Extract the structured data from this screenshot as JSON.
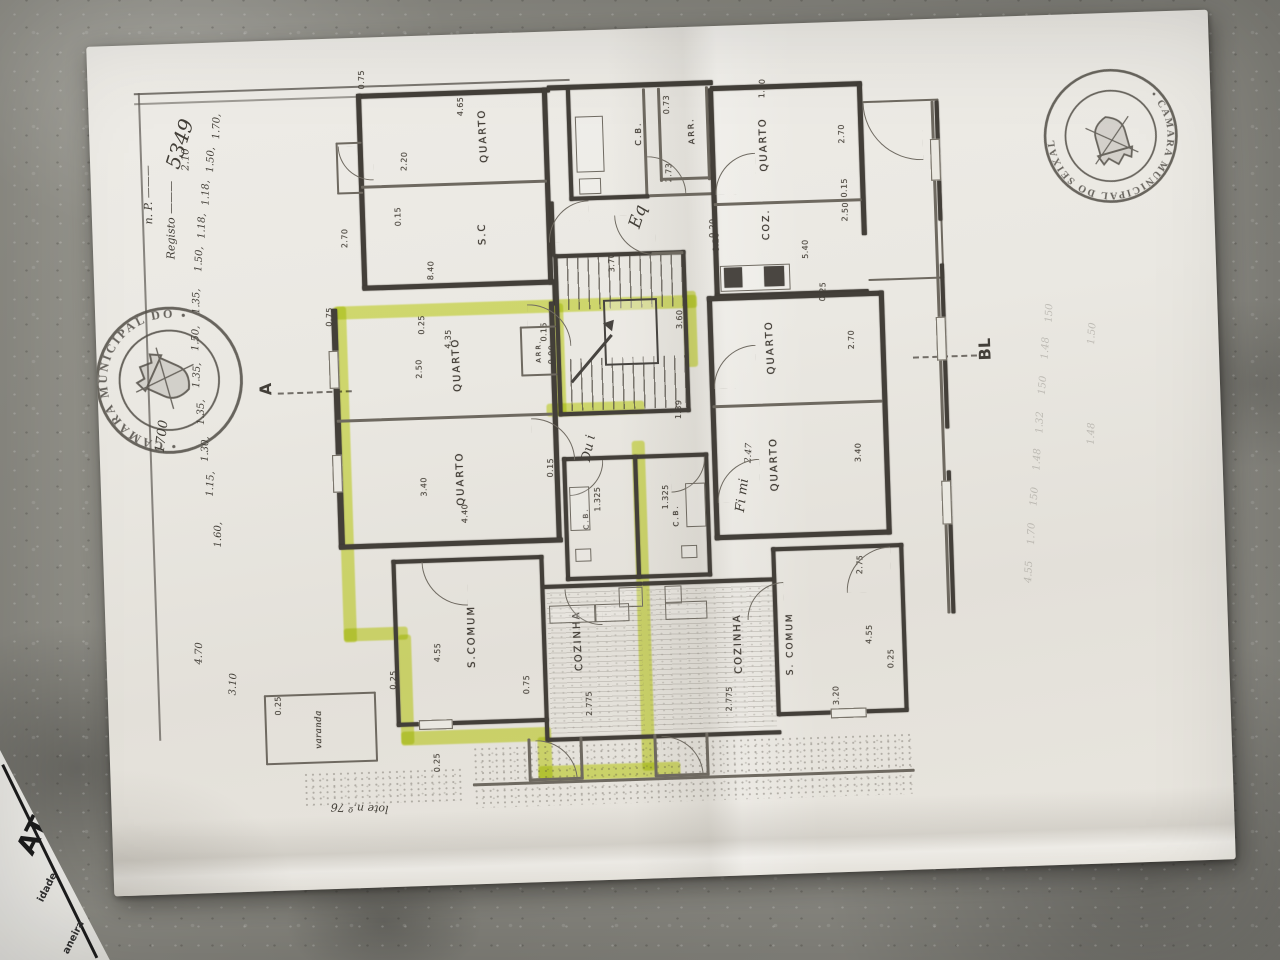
{
  "stamps": {
    "left_text": "• CÂMARA MUNICIPAL DO •",
    "right_text": "• CÂMARA MUNICIPAL DO SEIXAL"
  },
  "markers": {
    "a": "A",
    "b": "BL"
  },
  "at_paper": {
    "logo": "AT",
    "fragment1": "idade",
    "fragment2": "aneira"
  },
  "highlight": {
    "color": "rgba(214,228,70,0.72)",
    "segments": [
      [
        18,
        248,
        362,
        13
      ],
      [
        16,
        248,
        13,
        336
      ],
      [
        16,
        570,
        64,
        13
      ],
      [
        70,
        578,
        13,
        110
      ],
      [
        70,
        675,
        150,
        14
      ],
      [
        206,
        685,
        14,
        42
      ],
      [
        206,
        714,
        142,
        15
      ],
      [
        310,
        392,
        13,
        330
      ],
      [
        234,
        252,
        12,
        112
      ],
      [
        226,
        352,
        98,
        13
      ],
      [
        366,
        244,
        13,
        76
      ]
    ]
  },
  "rooms": [
    {
      "label": "QUARTO",
      "x": 172,
      "y": 82
    },
    {
      "label": "S.C",
      "x": 168,
      "y": 180
    },
    {
      "label": "C.B.",
      "x": 327,
      "y": 85,
      "s": 8
    },
    {
      "label": "ARR.",
      "x": 380,
      "y": 84,
      "s": 8
    },
    {
      "label": "QUARTO",
      "x": 452,
      "y": 100
    },
    {
      "label": "COZ.",
      "x": 452,
      "y": 180,
      "s": 9.5
    },
    {
      "label": "QUARTO",
      "x": 138,
      "y": 310
    },
    {
      "label": "QUARTO",
      "x": 138,
      "y": 424
    },
    {
      "label": "ARR.",
      "x": 220,
      "y": 299,
      "s": 6.5
    },
    {
      "label": "QUARTO",
      "x": 452,
      "y": 303
    },
    {
      "label": "QUARTO",
      "x": 452,
      "y": 420
    },
    {
      "label": "S.COMUM",
      "x": 144,
      "y": 582
    },
    {
      "label": "COZINHA",
      "x": 250,
      "y": 590
    },
    {
      "label": "COZINHA",
      "x": 410,
      "y": 598
    },
    {
      "label": "S. COMUM",
      "x": 462,
      "y": 600,
      "s": 9
    },
    {
      "label": "C.B.",
      "x": 262,
      "y": 468,
      "s": 7
    },
    {
      "label": "C.B.",
      "x": 352,
      "y": 468,
      "s": 7
    },
    {
      "label": "varanda",
      "x": -12,
      "y": 670,
      "s": 8.5,
      "hand": 1
    }
  ],
  "dims": [
    {
      "t": "0.75",
      "x": 52,
      "y": 22
    },
    {
      "t": "4.65",
      "x": 150,
      "y": 52
    },
    {
      "t": "2.20",
      "x": 92,
      "y": 105
    },
    {
      "t": "0.15",
      "x": 84,
      "y": 160
    },
    {
      "t": "2.70",
      "x": 30,
      "y": 180
    },
    {
      "t": "8.40",
      "x": 115,
      "y": 215
    },
    {
      "t": "0.73",
      "x": 356,
      "y": 57
    },
    {
      "t": "2.73",
      "x": 356,
      "y": 125
    },
    {
      "t": "1.20",
      "x": 452,
      "y": 44
    },
    {
      "t": "2.70",
      "x": 530,
      "y": 92
    },
    {
      "t": "0.15",
      "x": 531,
      "y": 146
    },
    {
      "t": "2.50",
      "x": 531,
      "y": 170
    },
    {
      "t": "5.40",
      "x": 490,
      "y": 206
    },
    {
      "t": "0.20",
      "x": 398,
      "y": 182
    },
    {
      "t": "0.25",
      "x": 506,
      "y": 249
    },
    {
      "t": "3.70",
      "x": 296,
      "y": 213
    },
    {
      "t": "3.60",
      "x": 362,
      "y": 272
    },
    {
      "t": "1.39",
      "x": 358,
      "y": 362
    },
    {
      "t": "0.20",
      "x": 401,
      "y": 196
    },
    {
      "t": "0.25",
      "x": 104,
      "y": 269
    },
    {
      "t": "4.35",
      "x": 130,
      "y": 284
    },
    {
      "t": "2.50",
      "x": 100,
      "y": 313
    },
    {
      "t": "0.15",
      "x": 226,
      "y": 280
    },
    {
      "t": "0.90",
      "x": 233,
      "y": 303
    },
    {
      "t": "3.40",
      "x": 101,
      "y": 431
    },
    {
      "t": "4.40",
      "x": 141,
      "y": 459
    },
    {
      "t": "0.15",
      "x": 228,
      "y": 416
    },
    {
      "t": "2.70",
      "x": 533,
      "y": 298
    },
    {
      "t": "3.40",
      "x": 536,
      "y": 411
    },
    {
      "t": "2.75",
      "x": 534,
      "y": 523
    },
    {
      "t": "1.325",
      "x": 274,
      "y": 449
    },
    {
      "t": "1.325",
      "x": 342,
      "y": 449
    },
    {
      "t": "0.25",
      "x": 64,
      "y": 623
    },
    {
      "t": "0.25",
      "x": 105,
      "y": 707
    },
    {
      "t": "0.75",
      "x": 197,
      "y": 632
    },
    {
      "t": "4.55",
      "x": 109,
      "y": 597
    },
    {
      "t": "2.775",
      "x": 259,
      "y": 653
    },
    {
      "t": "2.775",
      "x": 399,
      "y": 653
    },
    {
      "t": "4.55",
      "x": 541,
      "y": 593
    },
    {
      "t": "3.20",
      "x": 506,
      "y": 653
    },
    {
      "t": "0.25",
      "x": 562,
      "y": 618
    },
    {
      "t": "0.75",
      "x": 12,
      "y": 258
    },
    {
      "t": "0.25",
      "x": -52,
      "y": 645
    }
  ],
  "chain": [
    {
      "t": "2.10",
      "x": 96,
      "y": 116
    },
    {
      "t": "1.70,",
      "x": 128,
      "y": 84
    },
    {
      "t": "1.50,",
      "x": 121,
      "y": 117
    },
    {
      "t": "1.18,",
      "x": 115,
      "y": 150
    },
    {
      "t": "1.18,",
      "x": 110,
      "y": 183
    },
    {
      "t": "1.50,",
      "x": 106,
      "y": 216
    },
    {
      "t": "1.35,",
      "x": 102,
      "y": 258
    },
    {
      "t": "1.50,",
      "x": 100,
      "y": 295
    },
    {
      "t": "1.35,",
      "x": 100,
      "y": 332
    },
    {
      "t": "1.35,",
      "x": 103,
      "y": 369
    },
    {
      "t": "1.30,",
      "x": 106,
      "y": 406
    },
    {
      "t": "1.15,",
      "x": 110,
      "y": 441
    },
    {
      "t": "1.60,",
      "x": 116,
      "y": 492
    },
    {
      "t": "4.70",
      "x": 93,
      "y": 610
    },
    {
      "t": "3.10",
      "x": 126,
      "y": 642
    }
  ],
  "notes": [
    {
      "t": "n. P. ———",
      "x": 57,
      "y": 150,
      "r": -88,
      "s": 11
    },
    {
      "t": "Registo ———",
      "x": 79,
      "y": 176,
      "r": -88,
      "s": 11
    },
    {
      "t": "5349",
      "x": 90,
      "y": 100,
      "r": -72,
      "s": 20
    },
    {
      "t": "1700",
      "x": 63,
      "y": 392,
      "r": -80,
      "s": 13
    },
    {
      "t": "Eq",
      "x": 546,
      "y": 188,
      "r": -70,
      "s": 17
    },
    {
      "t": "Du i",
      "x": 489,
      "y": 418,
      "r": -78,
      "s": 13
    },
    {
      "t": "Fi mi",
      "x": 641,
      "y": 470,
      "r": -80,
      "s": 13
    },
    {
      "t": "2.47",
      "x": 649,
      "y": 428,
      "r": -85,
      "s": 9
    },
    {
      "t": "lote n.º 76",
      "x": 248,
      "y": 770,
      "r": 183,
      "s": 11
    }
  ],
  "ghosts": [
    {
      "t": "150",
      "x": 954,
      "y": 298
    },
    {
      "t": "1.48",
      "x": 949,
      "y": 333
    },
    {
      "t": "150",
      "x": 945,
      "y": 370
    },
    {
      "t": "1.32",
      "x": 941,
      "y": 407
    },
    {
      "t": "1.48",
      "x": 937,
      "y": 444
    },
    {
      "t": "150",
      "x": 933,
      "y": 481
    },
    {
      "t": "1.70",
      "x": 929,
      "y": 518
    },
    {
      "t": "4.55",
      "x": 925,
      "y": 556
    },
    {
      "t": "1.50",
      "x": 996,
      "y": 320
    },
    {
      "t": "1.48",
      "x": 992,
      "y": 420
    }
  ]
}
